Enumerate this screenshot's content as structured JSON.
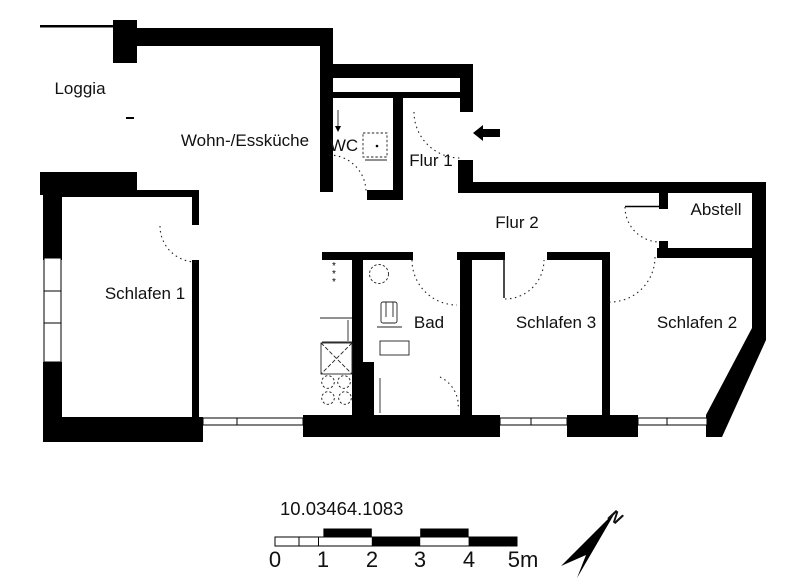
{
  "colors": {
    "wall": "#000000",
    "background": "#ffffff",
    "text": "#111111"
  },
  "rooms": {
    "loggia": {
      "label": "Loggia"
    },
    "kitchen": {
      "label": "Wohn-/Essküche"
    },
    "wc": {
      "label": "WC"
    },
    "flur1": {
      "label": "Flur 1"
    },
    "flur2": {
      "label": "Flur 2"
    },
    "abstell": {
      "label": "Abstell"
    },
    "schlafen1": {
      "label": "Schlafen 1"
    },
    "bad": {
      "label": "Bad"
    },
    "schlafen3": {
      "label": "Schlafen 3"
    },
    "schlafen2": {
      "label": "Schlafen 2"
    }
  },
  "annotations": {
    "plan_number": "10.03464.1083",
    "north_label": "N",
    "shaft_mark": "*"
  },
  "scale_bar": {
    "ticks": [
      "0",
      "1",
      "2",
      "3",
      "4"
    ],
    "end_label": "5m",
    "meters_total": 5
  }
}
